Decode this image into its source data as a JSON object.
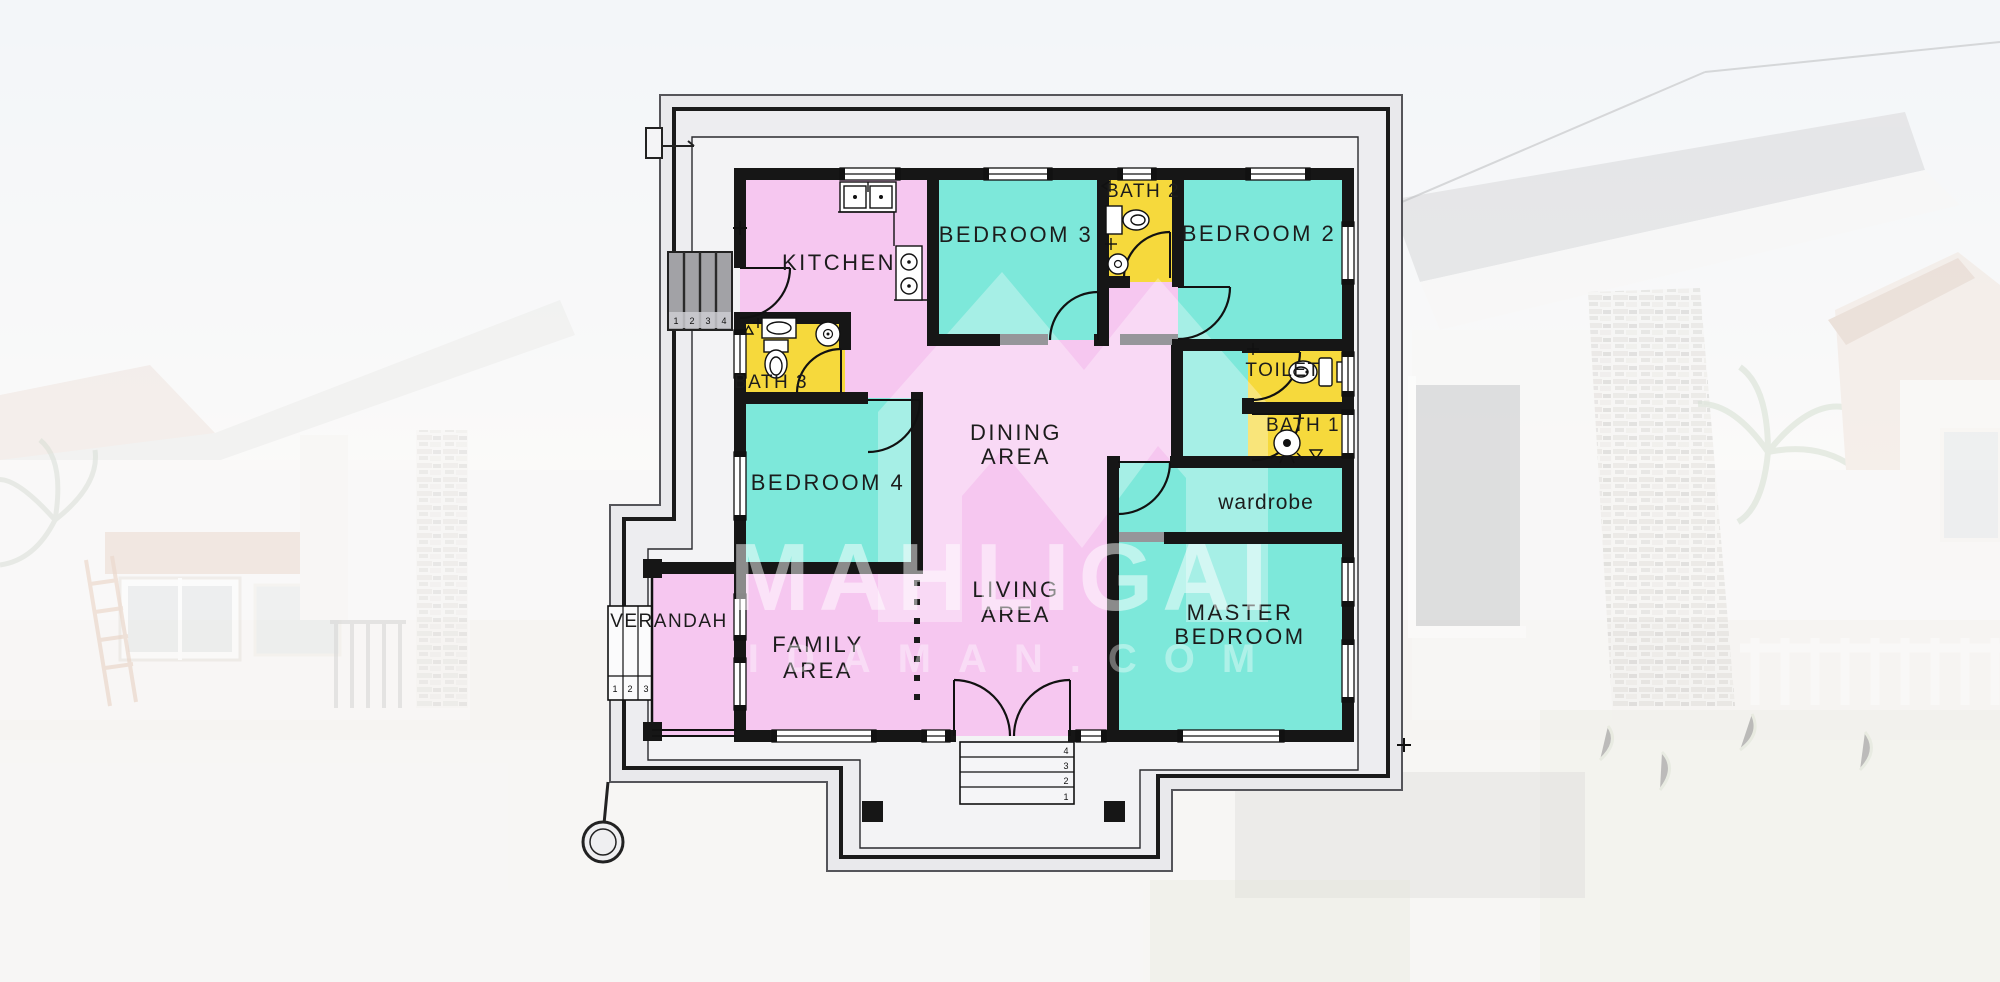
{
  "watermark": {
    "brand": "MAHLIGAI",
    "domain": "IDAMAN.COM"
  },
  "rooms": {
    "kitchen": "KITCHEN",
    "bedroom3": "BEDROOM 3",
    "bath2": "BATH 2",
    "bedroom2": "BEDROOM 2",
    "bath3": "BATH 3",
    "dining": {
      "l1": "DINING",
      "l2": "AREA"
    },
    "toilet": "TOILET",
    "bath1": "BATH 1",
    "bedroom4": "BEDROOM 4",
    "wardrobe": "wardrobe",
    "verandah": "VERANDAH",
    "family": {
      "l1": "FAMILY",
      "l2": "AREA"
    },
    "living": {
      "l1": "LIVING",
      "l2": "AREA"
    },
    "master": {
      "l1": "MASTER",
      "l2": "BEDROOM"
    }
  },
  "stairs": {
    "side_top": [
      "1",
      "2",
      "3",
      "4"
    ],
    "side_left": [
      "1",
      "2",
      "3"
    ],
    "front": [
      "4",
      "3",
      "2",
      "1"
    ]
  },
  "colors": {
    "room_pink": "#f6c7f0",
    "room_teal": "#7de8da",
    "room_yellow": "#f6d93c",
    "wall": "#161616",
    "threshold": "#96969a",
    "band_fill": "#e9e9ec",
    "stair_gray": "#a2a2a6"
  }
}
